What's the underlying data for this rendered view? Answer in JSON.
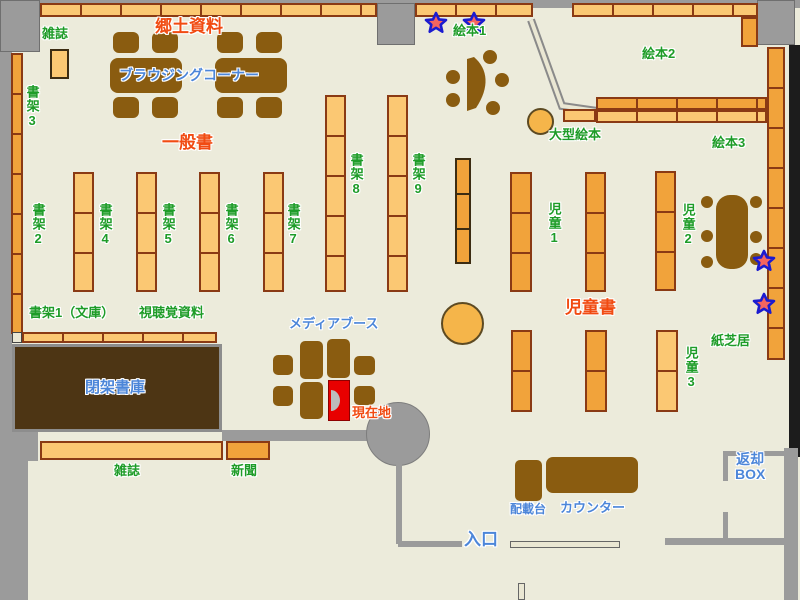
{
  "labels": {
    "magazines_top": "雑誌",
    "local_materials": "郷土資料",
    "browsing_corner": "ブラウジングコーナー",
    "shelf3": "書架3",
    "general_books": "一般書",
    "shelf2": "書架2",
    "shelf4": "書架4",
    "shelf5": "書架5",
    "shelf6": "書架6",
    "shelf7": "書架7",
    "shelf8": "書架8",
    "shelf9": "書架9",
    "picture_books1": "絵本1",
    "picture_books2": "絵本2",
    "large_picture_books": "大型絵本",
    "picture_books3": "絵本3",
    "children1": "児童1",
    "children2": "児童2",
    "children_books": "児童書",
    "kamishibai": "紙芝居",
    "children3": "児童3",
    "shelf1_bunko": "書架1（文庫）",
    "av_materials": "視聴覚資料",
    "media_booth": "メディアブース",
    "current_location": "現在地",
    "closed_stacks": "閉架書庫",
    "magazines_bottom": "雑誌",
    "newspapers": "新聞",
    "loading_table": "配載台",
    "counter": "カウンター",
    "entrance": "入口",
    "return_box_line1": "返却",
    "return_box_line2": "BOX"
  },
  "icons": {
    "star_marker": "★"
  },
  "colors": {
    "floor": "#ecebdb",
    "wall_gray": "#9b9b9b",
    "shelf_light": "#fbc873",
    "shelf_dark": "#f1a33b",
    "shelf_border": "#8a3a14",
    "furniture_brown": "#8a5c10",
    "closed_stacks_brown": "#4d3514",
    "label_green": "#1e9c28",
    "label_red": "#f14b12",
    "label_blue": "#4c86d9",
    "marker_red": "#e80000",
    "star_fill": "#f5655f",
    "star_outline": "#1b1bd0"
  }
}
